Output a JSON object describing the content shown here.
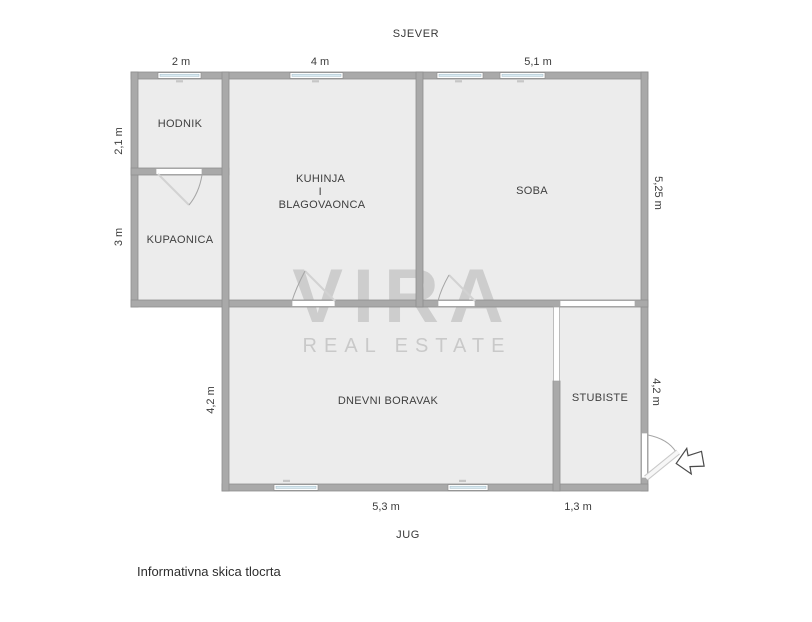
{
  "plan": {
    "compass": {
      "north": "SJEVER",
      "south": "JUG"
    },
    "rooms": {
      "hodnik": {
        "label": "HODNIK"
      },
      "kupaonica": {
        "label": "KUPAONICA"
      },
      "kuhinja": {
        "lines": [
          "KUHINJA",
          "I",
          "BLAGOVAONCA"
        ]
      },
      "soba": {
        "label": "SOBA"
      },
      "dnevni": {
        "label": "DNEVNI BORAVAK"
      },
      "stubiste": {
        "label": "STUBISTE"
      }
    },
    "dimensions": {
      "top_hodnik": "2 m",
      "top_kuhinja": "4 m",
      "top_soba": "5,1 m",
      "left_hodnik": "2,1 m",
      "left_kupaonica": "3 m",
      "left_dnevni": "4,2 m",
      "right_soba": "5,25 m",
      "right_stubiste": "4,2 m",
      "bottom_dnevni": "5,3 m",
      "bottom_stubiste": "1,3 m"
    },
    "watermark": {
      "brand": "VIRA",
      "tagline": "REAL ESTATE"
    },
    "caption": "Informativna skica tlocrta",
    "colors": {
      "wall": "#a9a9a9",
      "room_fill": "#ececec",
      "window_glass": "#d9eaf2",
      "text": "#3c3c3c",
      "watermark": "#b5b5b5"
    }
  }
}
